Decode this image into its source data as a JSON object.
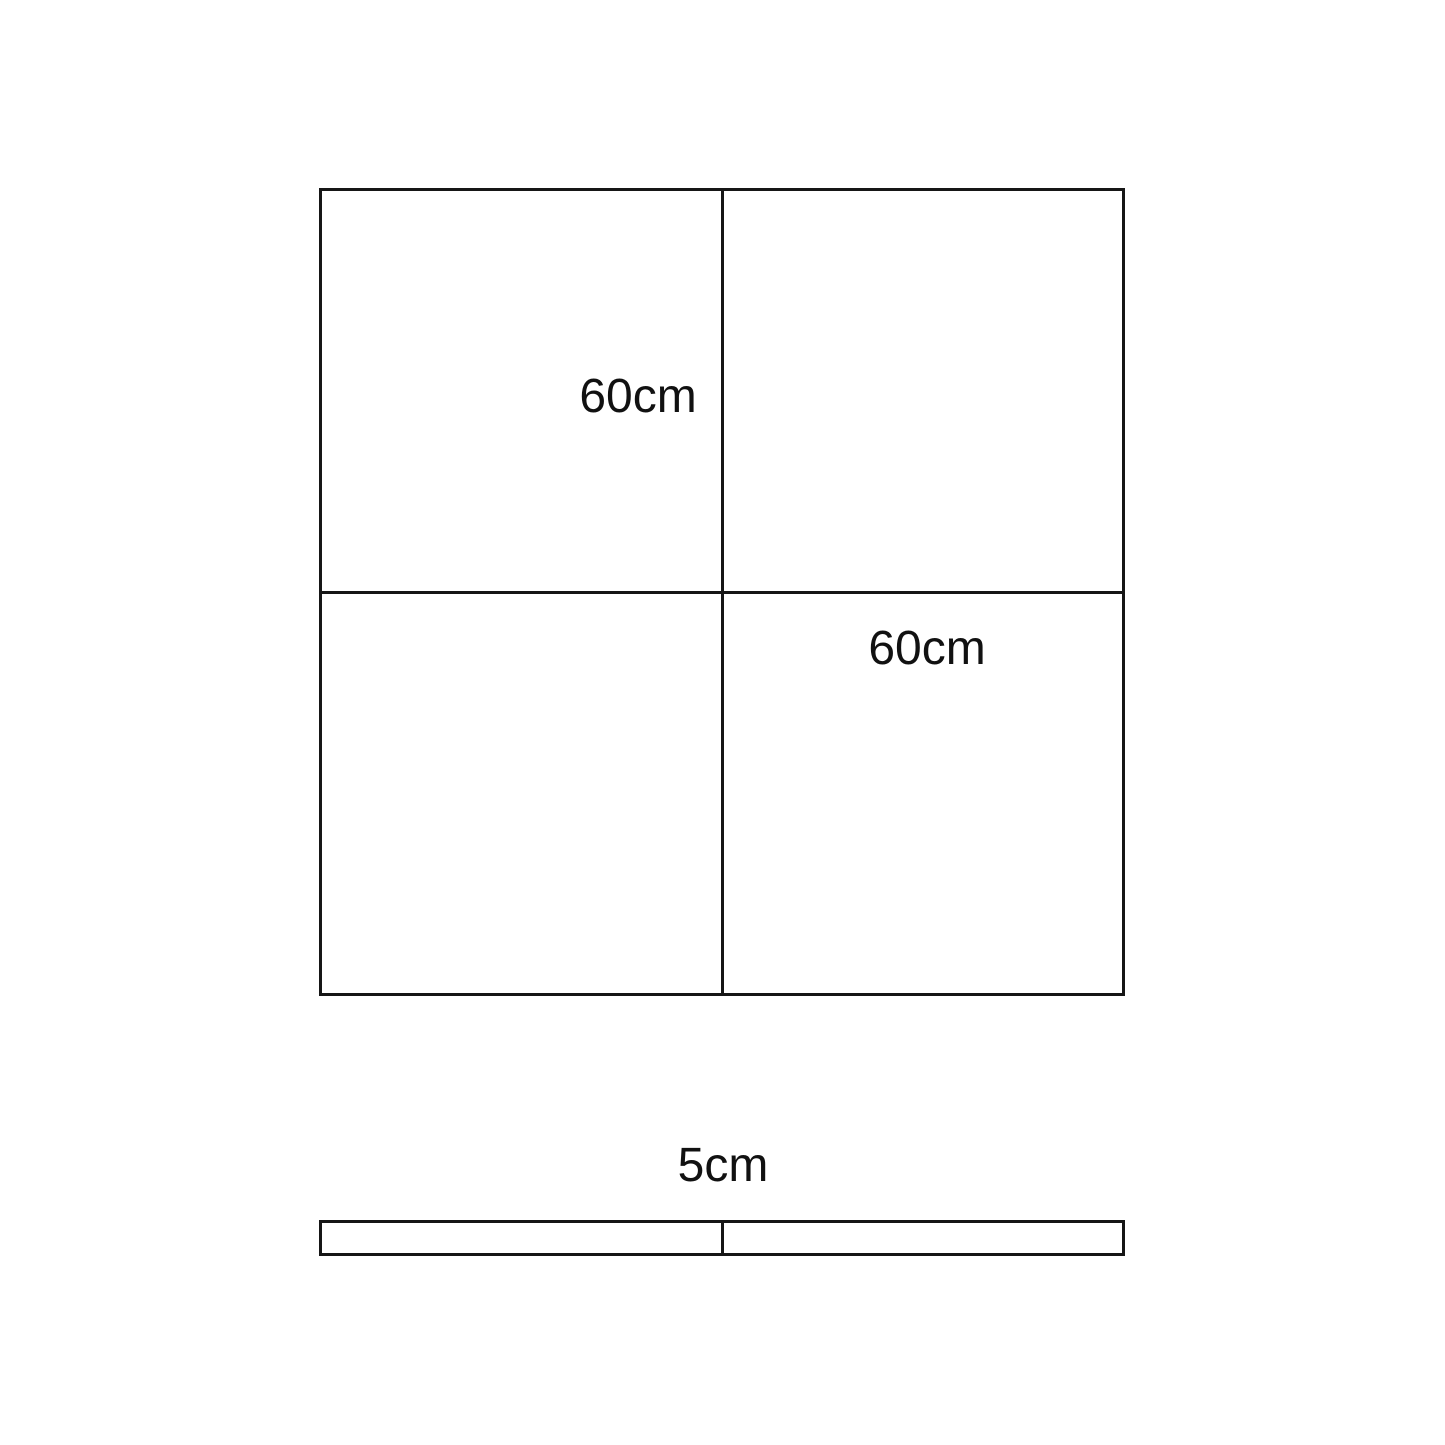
{
  "diagram": {
    "square": {
      "label_top_left": "60cm",
      "label_bottom_right": "60cm"
    },
    "strip": {
      "label": "5cm"
    },
    "colors": {
      "line": "#161616",
      "text": "#111111",
      "background": "#ffffff"
    }
  }
}
